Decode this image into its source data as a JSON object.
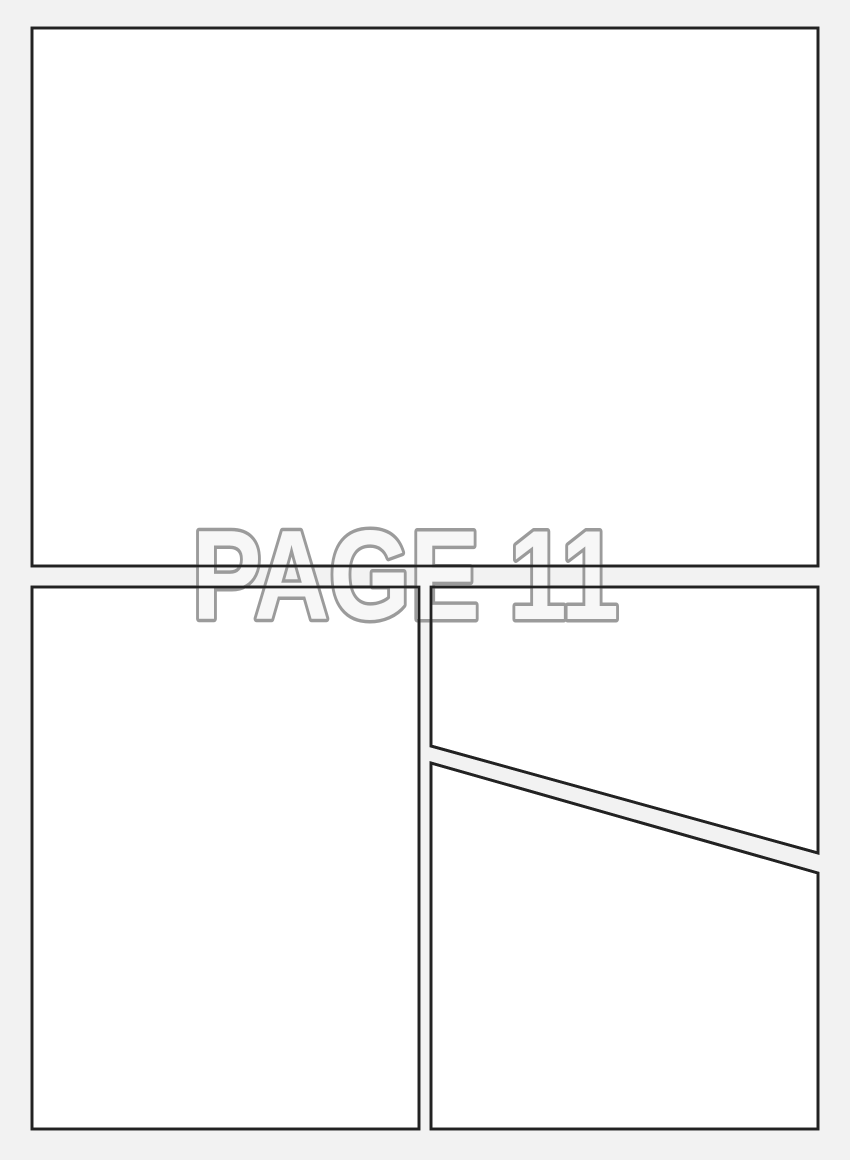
{
  "page": {
    "width": 850,
    "height": 1160,
    "background_color": "#f2f2f2"
  },
  "watermark": {
    "text": "PAGE 11",
    "fill_color": "#f7f7f7",
    "stroke_color": "#9b9b9b",
    "stroke_width": 7,
    "x": 192,
    "baseline_y": 619,
    "font_size": 127,
    "text_length": 427
  },
  "panel_style": {
    "fill": "#ffffff",
    "border_color": "#222222",
    "border_width": 2.8
  },
  "panels": [
    {
      "id": "panel-top",
      "points": [
        [
          32,
          28
        ],
        [
          818,
          28
        ],
        [
          818,
          566
        ],
        [
          32,
          566
        ]
      ]
    },
    {
      "id": "panel-bottom-left",
      "points": [
        [
          32,
          587
        ],
        [
          419,
          587
        ],
        [
          419,
          1129
        ],
        [
          32,
          1129
        ]
      ]
    },
    {
      "id": "panel-right-upper",
      "points": [
        [
          431,
          587
        ],
        [
          818,
          587
        ],
        [
          818,
          853
        ],
        [
          431,
          746
        ]
      ]
    },
    {
      "id": "panel-right-lower",
      "points": [
        [
          431,
          763
        ],
        [
          818,
          873
        ],
        [
          818,
          1129
        ],
        [
          431,
          1129
        ]
      ]
    }
  ]
}
